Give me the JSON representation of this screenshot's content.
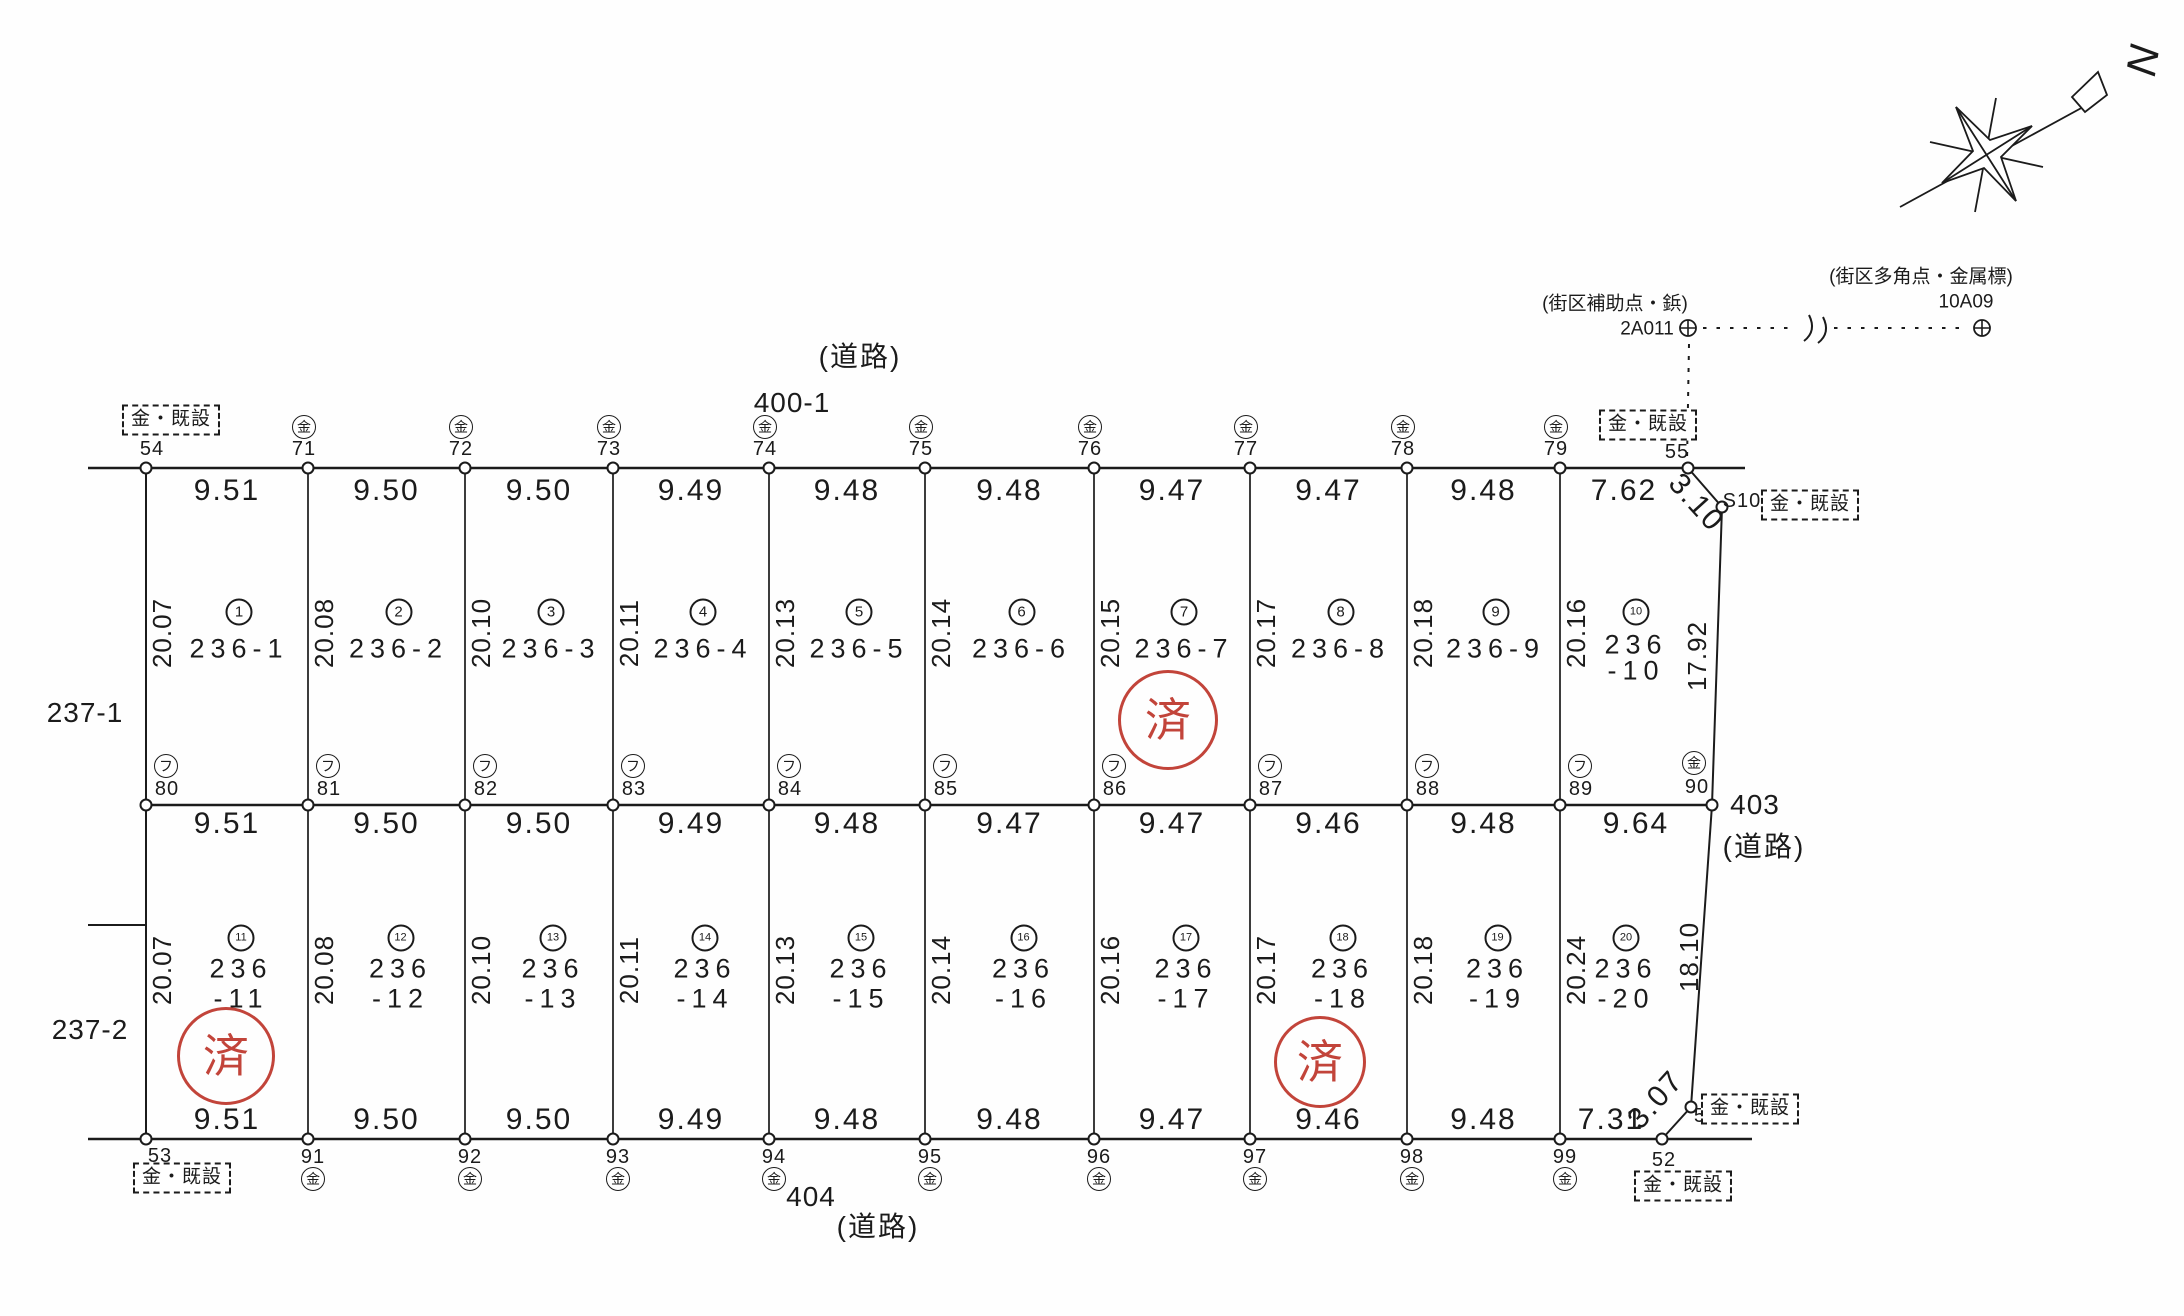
{
  "map": {
    "stamp_text": "済",
    "stamp_color": "#c2443a",
    "marker_box_label": "金・既設",
    "symbols": {
      "metal": "金",
      "plastic": "フ"
    },
    "compass": {
      "north": "N"
    },
    "roads": {
      "top": {
        "kind": "(道路)",
        "name": "400-1"
      },
      "right": {
        "name": "403",
        "kind": "(道路)"
      },
      "bottom": {
        "name": "404",
        "kind": "(道路)"
      }
    },
    "adjacent_parcels": {
      "upper": "237-1",
      "lower": "237-2"
    },
    "reference_points": {
      "aux": {
        "type_label": "(街区補助点・鋲)",
        "name": "2A011"
      },
      "poly": {
        "type_label": "(街区多角点・金属標)",
        "name": "10A09"
      }
    }
  },
  "points": {
    "top": [
      {
        "num": "54",
        "marker": "box"
      },
      {
        "num": "71",
        "marker": "kin"
      },
      {
        "num": "72",
        "marker": "kin"
      },
      {
        "num": "73",
        "marker": "kin"
      },
      {
        "num": "74",
        "marker": "kin"
      },
      {
        "num": "75",
        "marker": "kin"
      },
      {
        "num": "76",
        "marker": "kin"
      },
      {
        "num": "77",
        "marker": "kin"
      },
      {
        "num": "78",
        "marker": "kin"
      },
      {
        "num": "79",
        "marker": "kin"
      },
      {
        "num": "55",
        "marker": "box"
      }
    ],
    "middle": [
      {
        "num": "80",
        "marker": "fu"
      },
      {
        "num": "81",
        "marker": "fu"
      },
      {
        "num": "82",
        "marker": "fu"
      },
      {
        "num": "83",
        "marker": "fu"
      },
      {
        "num": "84",
        "marker": "fu"
      },
      {
        "num": "85",
        "marker": "fu"
      },
      {
        "num": "86",
        "marker": "fu"
      },
      {
        "num": "87",
        "marker": "fu"
      },
      {
        "num": "88",
        "marker": "fu"
      },
      {
        "num": "89",
        "marker": "fu"
      },
      {
        "num": "90",
        "marker": "kin"
      }
    ],
    "bottom": [
      {
        "num": "53",
        "marker": "box"
      },
      {
        "num": "91",
        "marker": "kin"
      },
      {
        "num": "92",
        "marker": "kin"
      },
      {
        "num": "93",
        "marker": "kin"
      },
      {
        "num": "94",
        "marker": "kin"
      },
      {
        "num": "95",
        "marker": "kin"
      },
      {
        "num": "96",
        "marker": "kin"
      },
      {
        "num": "97",
        "marker": "kin"
      },
      {
        "num": "98",
        "marker": "kin"
      },
      {
        "num": "99",
        "marker": "kin"
      },
      {
        "num": "52",
        "marker": "box"
      }
    ],
    "extra": [
      {
        "num": "51",
        "marker": "box"
      },
      {
        "num": "S100",
        "marker": "box"
      }
    ]
  },
  "dims": {
    "top": [
      "9.51",
      "9.50",
      "9.50",
      "9.49",
      "9.48",
      "9.48",
      "9.47",
      "9.47",
      "9.48",
      "7.62"
    ],
    "middle": [
      "9.51",
      "9.50",
      "9.50",
      "9.49",
      "9.48",
      "9.47",
      "9.47",
      "9.46",
      "9.48",
      "9.64"
    ],
    "bottom": [
      "9.51",
      "9.50",
      "9.50",
      "9.49",
      "9.48",
      "9.48",
      "9.47",
      "9.46",
      "9.48",
      "7.31"
    ],
    "diag_top": "3.10",
    "diag_bottom": "3.07",
    "right_row1": "17.92",
    "right_row2": "18.10"
  },
  "parcels": {
    "row1": [
      {
        "no": "1",
        "lines": [
          "236-1"
        ],
        "side": "20.07"
      },
      {
        "no": "2",
        "lines": [
          "236-2"
        ],
        "side": "20.08"
      },
      {
        "no": "3",
        "lines": [
          "236-3"
        ],
        "side": "20.10"
      },
      {
        "no": "4",
        "lines": [
          "236-4"
        ],
        "side": "20.11"
      },
      {
        "no": "5",
        "lines": [
          "236-5"
        ],
        "side": "20.13"
      },
      {
        "no": "6",
        "lines": [
          "236-6"
        ],
        "side": "20.14"
      },
      {
        "no": "7",
        "lines": [
          "236-7"
        ],
        "side": "20.15",
        "stamp": true
      },
      {
        "no": "8",
        "lines": [
          "236-8"
        ],
        "side": "20.17"
      },
      {
        "no": "9",
        "lines": [
          "236-9"
        ],
        "side": "20.18"
      },
      {
        "no": "10",
        "lines": [
          "236",
          "-10"
        ],
        "side": "20.16",
        "right": "17.92"
      }
    ],
    "row2": [
      {
        "no": "11",
        "lines": [
          "236",
          "-11"
        ],
        "side": "20.07",
        "stamp": true
      },
      {
        "no": "12",
        "lines": [
          "236",
          "-12"
        ],
        "side": "20.08"
      },
      {
        "no": "13",
        "lines": [
          "236",
          "-13"
        ],
        "side": "20.10"
      },
      {
        "no": "14",
        "lines": [
          "236",
          "-14"
        ],
        "side": "20.11"
      },
      {
        "no": "15",
        "lines": [
          "236",
          "-15"
        ],
        "side": "20.13"
      },
      {
        "no": "16",
        "lines": [
          "236",
          "-16"
        ],
        "side": "20.14"
      },
      {
        "no": "17",
        "lines": [
          "236",
          "-17"
        ],
        "side": "20.16"
      },
      {
        "no": "18",
        "lines": [
          "236",
          "-18"
        ],
        "side": "20.17",
        "stamp": true
      },
      {
        "no": "19",
        "lines": [
          "236",
          "-19"
        ],
        "side": "20.18"
      },
      {
        "no": "20",
        "lines": [
          "236",
          "-20"
        ],
        "side": "20.24",
        "right": "18.10"
      }
    ]
  },
  "stamps": [
    {
      "parcel": "236-7"
    },
    {
      "parcel": "236-11"
    },
    {
      "parcel": "236-18"
    }
  ]
}
